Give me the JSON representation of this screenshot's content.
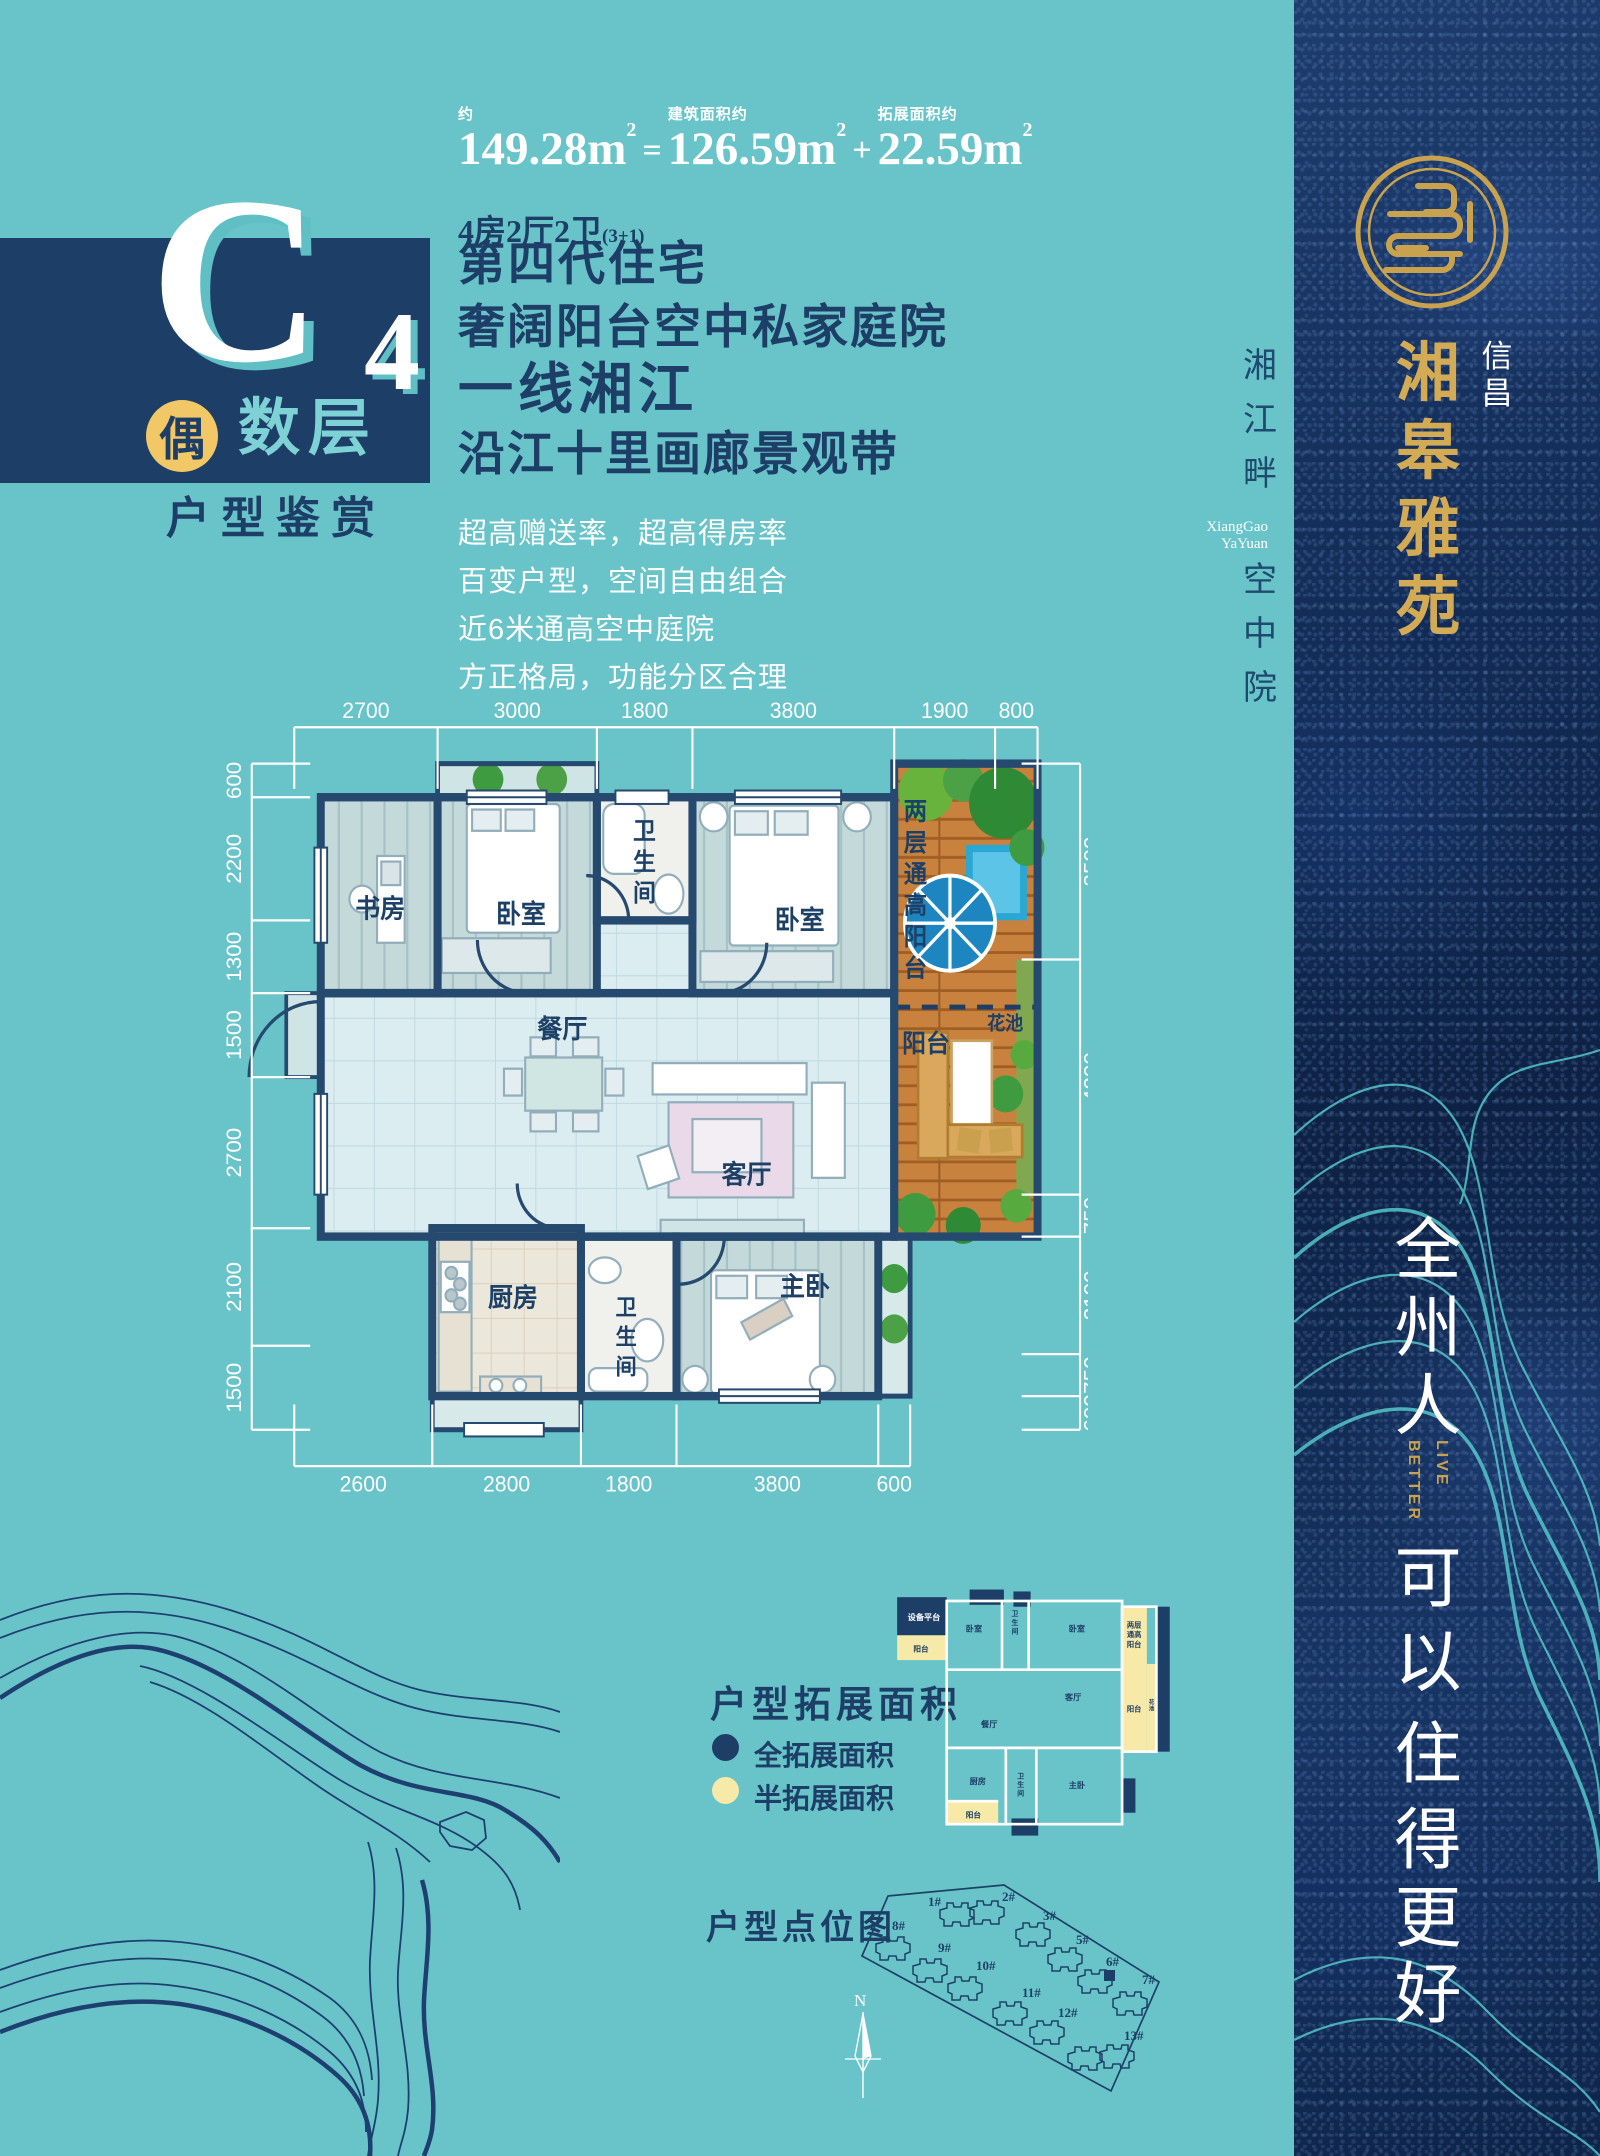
{
  "unit_header": {
    "approx_label": "约",
    "total_area": "149.28",
    "equals": "=",
    "built_label": "建筑面积约",
    "built_area": "126.59",
    "plus": "+",
    "expand_label": "拓展面积约",
    "expand_area": "22.59",
    "layout": "4房2厅2卫",
    "layout_note": "(3+1)"
  },
  "c4": {
    "letter": "C",
    "number": "4",
    "badge": "偶",
    "floors": "数层",
    "subtitle": "户型鉴赏"
  },
  "headline": {
    "lines": [
      "第四代住宅",
      "奢阔阳台空中私家庭院",
      "一线湘江",
      "沿江十里画廊景观带"
    ]
  },
  "features": [
    "超高赠送率，超高得房率",
    "百变户型，空间自由组合",
    "近6米通高空中庭院",
    "方正格局，功能分区合理"
  ],
  "floorplan": {
    "dims_top": [
      "2700",
      "3000",
      "1800",
      "3800",
      "1900",
      "800"
    ],
    "dims_left": [
      "600",
      "2200",
      "1300",
      "1500",
      "2700",
      "2100",
      "1500"
    ],
    "dims_right": [
      "3500",
      "4200",
      "750",
      "2100",
      "750",
      "600"
    ],
    "dims_bottom": [
      "2600",
      "2800",
      "1800",
      "3800",
      "600"
    ],
    "rooms": {
      "study": "书房",
      "bedroom_a": "卧室",
      "bedroom_b": "卧室",
      "dining": "餐厅",
      "living": "客厅",
      "kitchen": "厨房",
      "master": "主卧",
      "balcony": "阳台",
      "flowerbed": "花池"
    },
    "bath_chars": [
      "卫",
      "生",
      "间"
    ],
    "double_balcony_chars": [
      "两",
      "层",
      "通",
      "高",
      "阳",
      "台"
    ]
  },
  "expansion": {
    "title": "户型拓展面积",
    "legend": [
      {
        "label": "全拓展面积",
        "color": "#1d3e66"
      },
      {
        "label": "半拓展面积",
        "color": "#f7e9a8"
      }
    ],
    "mini": {
      "equipment": "设备平台",
      "balcony_top": "阳台",
      "bedroom": "卧室",
      "bedroom2": "卧室",
      "living": "客厅",
      "dining": "餐厅",
      "kitchen": "厨房",
      "master": "主卧",
      "balcony_bottom": "阳台",
      "balcony_right": "阳台",
      "double_rows": [
        "两层",
        "通高",
        "阳台"
      ],
      "flowerbed_chars": [
        "花",
        "池"
      ]
    }
  },
  "site_map": {
    "title": "户型点位图",
    "north": "N",
    "buildings": [
      "1#",
      "2#",
      "3#",
      "5#",
      "6#",
      "7#",
      "8#",
      "9#",
      "10#",
      "11#",
      "12#",
      "13#"
    ]
  },
  "side_strip": {
    "river_chars": [
      "湘",
      "江",
      "畔"
    ],
    "en_line1": "XiangGao",
    "en_line2": "YaYuan",
    "court_chars": [
      "空",
      "中",
      "院"
    ]
  },
  "sidebar": {
    "company_chars": [
      "信",
      "昌"
    ],
    "brand_chars": [
      "湘",
      "皋",
      "雅",
      "苑"
    ],
    "slogan_top_chars": [
      "全",
      "州",
      "人"
    ],
    "live": "LIVE",
    "better": "BETTER",
    "slogan_bottom_chars": [
      "可",
      "以",
      "住",
      "得",
      "更",
      "好"
    ]
  },
  "colors": {
    "teal_bg": "#69c4c9",
    "navy": "#1d3e66",
    "gold": "#c9a24e",
    "pale_yellow": "#f7e9a8",
    "deck_wood": "#c8823d"
  }
}
